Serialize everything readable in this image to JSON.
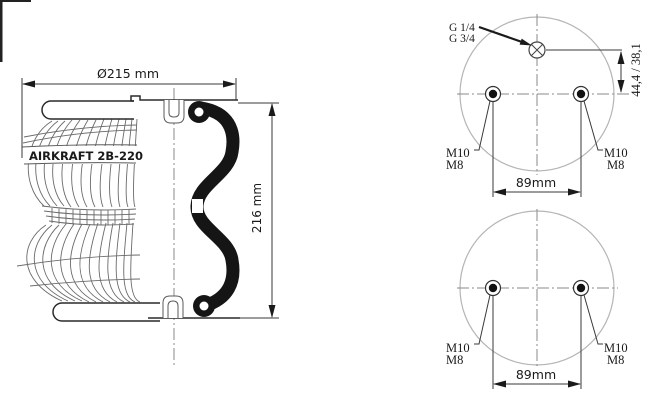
{
  "side_view": {
    "part_label": "AIRKRAFT 2B-220",
    "diameter_dim": "Ø215 mm",
    "height_dim": "216 mm"
  },
  "top_plan_view": {
    "port_thread_line1": "G 1/4",
    "port_thread_line2": "G 3/4",
    "port_offset_dim": "44,4 / 38,1",
    "left_stud": {
      "thread_line1": "M10",
      "thread_line2": "M8"
    },
    "right_stud": {
      "thread_line1": "M10",
      "thread_line2": "M8"
    },
    "stud_spacing_dim": "89mm"
  },
  "bottom_plan_view": {
    "left_stud": {
      "thread_line1": "M10",
      "thread_line2": "M8"
    },
    "right_stud": {
      "thread_line1": "M10",
      "thread_line2": "M8"
    },
    "stud_spacing_dim": "89mm"
  },
  "colors": {
    "background": "#ffffff",
    "thin_line": "#5a5a5a",
    "dimension_line": "#3a3a3a",
    "section_black": "#151515",
    "circle_outline": "#b5b5b5",
    "text": "#1a1a1a"
  }
}
